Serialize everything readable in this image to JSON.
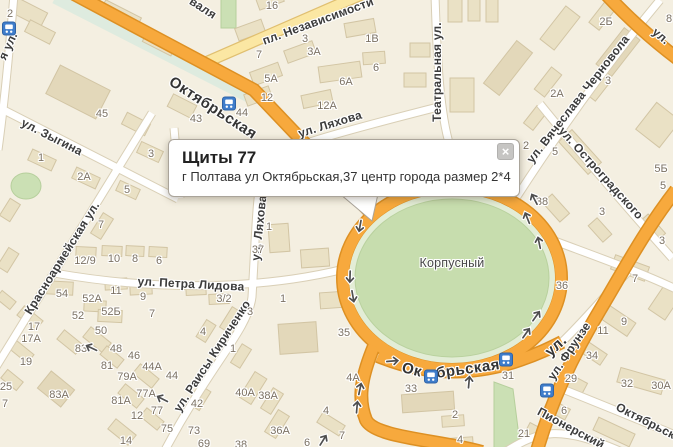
{
  "popup": {
    "title": "Щиты 77",
    "body": "г Полтава ул Октябрьская,37 центр города размер 2*4",
    "close_glyph": "×"
  },
  "colors": {
    "background": "#F4EFE1",
    "building": "#EAE1C5",
    "building_dark": "#E3D8BA",
    "road_major": "#F7A93D",
    "road_major_casing": "#DD9023",
    "road_secondary": "#FBE7A3",
    "road_white": "#FFFFFF",
    "park_green": "#C7DDAE",
    "park_rim": "#E3EDD6",
    "bus_icon_blue": "#3F7DCB",
    "label_text": "#3C3C3C",
    "building_label_text": "#7B7163"
  },
  "map": {
    "park_label": {
      "text": "Корпусный",
      "x": 452,
      "y": 263
    },
    "street_labels": [
      {
        "text": "Октябрьская",
        "x": 213,
        "y": 108,
        "rot": 33,
        "kind": "major"
      },
      {
        "text": "пл. Независимости",
        "x": 318,
        "y": 21,
        "rot": -20,
        "kind": ""
      },
      {
        "text": "ул. Ляхова",
        "x": 330,
        "y": 124,
        "rot": -17,
        "kind": ""
      },
      {
        "text": "Театральная ул.",
        "x": 437,
        "y": 72,
        "rot": -90,
        "kind": ""
      },
      {
        "text": "ул. Вячеслава Черновола",
        "x": 578,
        "y": 99,
        "rot": -52,
        "kind": ""
      },
      {
        "text": "ул. Остроградского",
        "x": 601,
        "y": 173,
        "rot": 48,
        "kind": ""
      },
      {
        "text": "ул. Зыгина",
        "x": 52,
        "y": 137,
        "rot": 27,
        "kind": ""
      },
      {
        "text": "Красноармейская ул.",
        "x": 62,
        "y": 258,
        "rot": -58,
        "kind": ""
      },
      {
        "text": "ул. Петра Лидова",
        "x": 191,
        "y": 284,
        "rot": 3,
        "kind": ""
      },
      {
        "text": "ул. Раисы Кириченко",
        "x": 212,
        "y": 356,
        "rot": -57,
        "kind": ""
      },
      {
        "text": "ул. Ляхова",
        "x": 259,
        "y": 228,
        "rot": -84,
        "kind": ""
      },
      {
        "text": "Ок",
        "x": 412,
        "y": 370,
        "rot": 14,
        "kind": "major"
      },
      {
        "text": "брьская",
        "x": 468,
        "y": 369,
        "rot": -8,
        "kind": "major"
      },
      {
        "text": "ул.",
        "x": 556,
        "y": 346,
        "rot": -42,
        "kind": "major"
      },
      {
        "text": "ул. Фрунзе",
        "x": 569,
        "y": 351,
        "rot": -56,
        "kind": ""
      },
      {
        "text": "Пионерский",
        "x": 571,
        "y": 428,
        "rot": 28,
        "kind": ""
      },
      {
        "text": "Октябрьская",
        "x": 652,
        "y": 424,
        "rot": 27,
        "kind": ""
      },
      {
        "text": "валя",
        "x": 203,
        "y": 8,
        "rot": 33,
        "kind": ""
      },
      {
        "text": "я ул.",
        "x": 8,
        "y": 46,
        "rot": -65,
        "kind": ""
      },
      {
        "text": "ул.",
        "x": 661,
        "y": 36,
        "rot": 40,
        "kind": ""
      }
    ],
    "building_labels": [
      {
        "text": "2",
        "x": 10,
        "y": 14
      },
      {
        "text": "45",
        "x": 102,
        "y": 114
      },
      {
        "text": "43",
        "x": 196,
        "y": 119
      },
      {
        "text": "16",
        "x": 272,
        "y": 6
      },
      {
        "text": "7",
        "x": 259,
        "y": 55
      },
      {
        "text": "3",
        "x": 305,
        "y": 39
      },
      {
        "text": "3А",
        "x": 314,
        "y": 52
      },
      {
        "text": "1В",
        "x": 372,
        "y": 39
      },
      {
        "text": "6",
        "x": 376,
        "y": 68
      },
      {
        "text": "5А",
        "x": 271,
        "y": 79
      },
      {
        "text": "6А",
        "x": 346,
        "y": 82
      },
      {
        "text": "12",
        "x": 267,
        "y": 98
      },
      {
        "text": "44",
        "x": 242,
        "y": 113
      },
      {
        "text": "12А",
        "x": 327,
        "y": 106
      },
      {
        "text": "2Б",
        "x": 606,
        "y": 22
      },
      {
        "text": "8",
        "x": 669,
        "y": 19
      },
      {
        "text": "3",
        "x": 608,
        "y": 81
      },
      {
        "text": "2А",
        "x": 557,
        "y": 94
      },
      {
        "text": "2",
        "x": 526,
        "y": 146
      },
      {
        "text": "5",
        "x": 555,
        "y": 152
      },
      {
        "text": "5Б",
        "x": 661,
        "y": 169
      },
      {
        "text": "5",
        "x": 663,
        "y": 186
      },
      {
        "text": "38",
        "x": 542,
        "y": 202
      },
      {
        "text": "3",
        "x": 602,
        "y": 212
      },
      {
        "text": "3",
        "x": 662,
        "y": 241
      },
      {
        "text": "7",
        "x": 635,
        "y": 279
      },
      {
        "text": "36",
        "x": 562,
        "y": 286
      },
      {
        "text": "1",
        "x": 269,
        "y": 227
      },
      {
        "text": "37",
        "x": 258,
        "y": 250
      },
      {
        "text": "1",
        "x": 283,
        "y": 299
      },
      {
        "text": "3/2",
        "x": 224,
        "y": 299
      },
      {
        "text": "3",
        "x": 250,
        "y": 312
      },
      {
        "text": "4",
        "x": 203,
        "y": 332
      },
      {
        "text": "1",
        "x": 233,
        "y": 349
      },
      {
        "text": "35",
        "x": 344,
        "y": 333
      },
      {
        "text": "12/9",
        "x": 85,
        "y": 261
      },
      {
        "text": "10",
        "x": 114,
        "y": 259
      },
      {
        "text": "8",
        "x": 135,
        "y": 259
      },
      {
        "text": "6",
        "x": 159,
        "y": 261
      },
      {
        "text": "54",
        "x": 62,
        "y": 294
      },
      {
        "text": "52А",
        "x": 92,
        "y": 299
      },
      {
        "text": "11",
        "x": 116,
        "y": 291
      },
      {
        "text": "9",
        "x": 143,
        "y": 297
      },
      {
        "text": "52",
        "x": 78,
        "y": 316
      },
      {
        "text": "52Б",
        "x": 111,
        "y": 312
      },
      {
        "text": "7",
        "x": 152,
        "y": 314
      },
      {
        "text": "17",
        "x": 34,
        "y": 327
      },
      {
        "text": "17А",
        "x": 31,
        "y": 339
      },
      {
        "text": "50",
        "x": 101,
        "y": 331
      },
      {
        "text": "83",
        "x": 81,
        "y": 349
      },
      {
        "text": "48",
        "x": 116,
        "y": 349
      },
      {
        "text": "46",
        "x": 134,
        "y": 356
      },
      {
        "text": "19",
        "x": 26,
        "y": 362
      },
      {
        "text": "44А",
        "x": 152,
        "y": 367
      },
      {
        "text": "44",
        "x": 172,
        "y": 376
      },
      {
        "text": "25",
        "x": 6,
        "y": 387
      },
      {
        "text": "83А",
        "x": 59,
        "y": 395
      },
      {
        "text": "79А",
        "x": 127,
        "y": 377
      },
      {
        "text": "77А",
        "x": 146,
        "y": 394
      },
      {
        "text": "81",
        "x": 107,
        "y": 366
      },
      {
        "text": "81А",
        "x": 121,
        "y": 401
      },
      {
        "text": "12",
        "x": 137,
        "y": 416
      },
      {
        "text": "77",
        "x": 157,
        "y": 411
      },
      {
        "text": "75",
        "x": 167,
        "y": 429
      },
      {
        "text": "14",
        "x": 126,
        "y": 441
      },
      {
        "text": "7",
        "x": 5,
        "y": 404
      },
      {
        "text": "40А",
        "x": 245,
        "y": 393
      },
      {
        "text": "38А",
        "x": 268,
        "y": 396
      },
      {
        "text": "42",
        "x": 197,
        "y": 404
      },
      {
        "text": "73",
        "x": 194,
        "y": 431
      },
      {
        "text": "36А",
        "x": 280,
        "y": 431
      },
      {
        "text": "69",
        "x": 204,
        "y": 444
      },
      {
        "text": "38",
        "x": 241,
        "y": 445
      },
      {
        "text": "6",
        "x": 307,
        "y": 443
      },
      {
        "text": "4",
        "x": 326,
        "y": 411
      },
      {
        "text": "7",
        "x": 342,
        "y": 436
      },
      {
        "text": "4А",
        "x": 353,
        "y": 378
      },
      {
        "text": "33",
        "x": 411,
        "y": 389
      },
      {
        "text": "31",
        "x": 508,
        "y": 376
      },
      {
        "text": "2",
        "x": 455,
        "y": 415
      },
      {
        "text": "4",
        "x": 460,
        "y": 440
      },
      {
        "text": "9",
        "x": 624,
        "y": 322
      },
      {
        "text": "11",
        "x": 603,
        "y": 331
      },
      {
        "text": "34",
        "x": 592,
        "y": 356
      },
      {
        "text": "29",
        "x": 571,
        "y": 379
      },
      {
        "text": "32",
        "x": 627,
        "y": 384
      },
      {
        "text": "30А",
        "x": 661,
        "y": 386
      },
      {
        "text": "21",
        "x": 524,
        "y": 434
      },
      {
        "text": "6",
        "x": 564,
        "y": 411
      },
      {
        "text": "1",
        "x": 41,
        "y": 158
      },
      {
        "text": "2А",
        "x": 84,
        "y": 177
      },
      {
        "text": "3",
        "x": 151,
        "y": 154
      },
      {
        "text": "5",
        "x": 127,
        "y": 190
      },
      {
        "text": "7",
        "x": 101,
        "y": 225
      }
    ],
    "bus_stops": [
      {
        "x": 9,
        "y": 31
      },
      {
        "x": 229,
        "y": 106
      },
      {
        "x": 431,
        "y": 379
      },
      {
        "x": 506,
        "y": 362
      },
      {
        "x": 547,
        "y": 393
      }
    ],
    "arrows": [
      {
        "x": 92,
        "y": 346,
        "rot": 205
      },
      {
        "x": 163,
        "y": 397,
        "rot": 207
      },
      {
        "x": 358,
        "y": 226,
        "rot": 100
      },
      {
        "x": 348,
        "y": 277,
        "rot": 92
      },
      {
        "x": 351,
        "y": 297,
        "rot": 80
      },
      {
        "x": 536,
        "y": 198,
        "rot": -118
      },
      {
        "x": 529,
        "y": 217,
        "rot": -112
      },
      {
        "x": 541,
        "y": 242,
        "rot": -102
      },
      {
        "x": 393,
        "y": 363,
        "rot": -5
      },
      {
        "x": 471,
        "y": 382,
        "rot": -85
      },
      {
        "x": 362,
        "y": 389,
        "rot": -78
      },
      {
        "x": 359,
        "y": 407,
        "rot": -85
      },
      {
        "x": 325,
        "y": 441,
        "rot": -58
      },
      {
        "x": 528,
        "y": 334,
        "rot": -55
      },
      {
        "x": 538,
        "y": 317,
        "rot": -55
      }
    ]
  }
}
